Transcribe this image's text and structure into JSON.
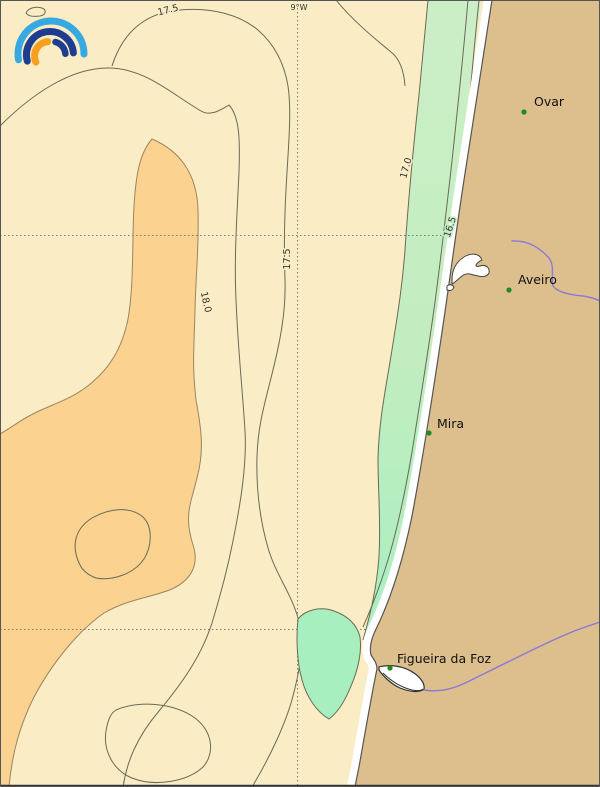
{
  "graticule": {
    "meridian_label": "9°W"
  },
  "isotherms": {
    "labels": [
      "17.5",
      "17.5",
      "18.0",
      "17.0",
      "16.5"
    ]
  },
  "towns": [
    {
      "name": "Ovar"
    },
    {
      "name": "Aveiro"
    },
    {
      "name": "Mira"
    },
    {
      "name": "Figueira da Foz"
    }
  ],
  "colors": {
    "ocean_cream": "#FAECC4",
    "ocean_orange": "#FBD28F",
    "coastal_green_light": "#C9EEC4",
    "coastal_green_mint": "#A8EFC0",
    "land_tan": "#DCBF8D",
    "beach_white": "#FFFFFF",
    "contour_gray": "#6a6a55",
    "river_blue": "#8A7AD6",
    "town_marker_green": "#1E8C1E",
    "logo_light_blue": "#36A9E1",
    "logo_dark_blue": "#1F3D8F",
    "logo_orange": "#F7A01D"
  }
}
